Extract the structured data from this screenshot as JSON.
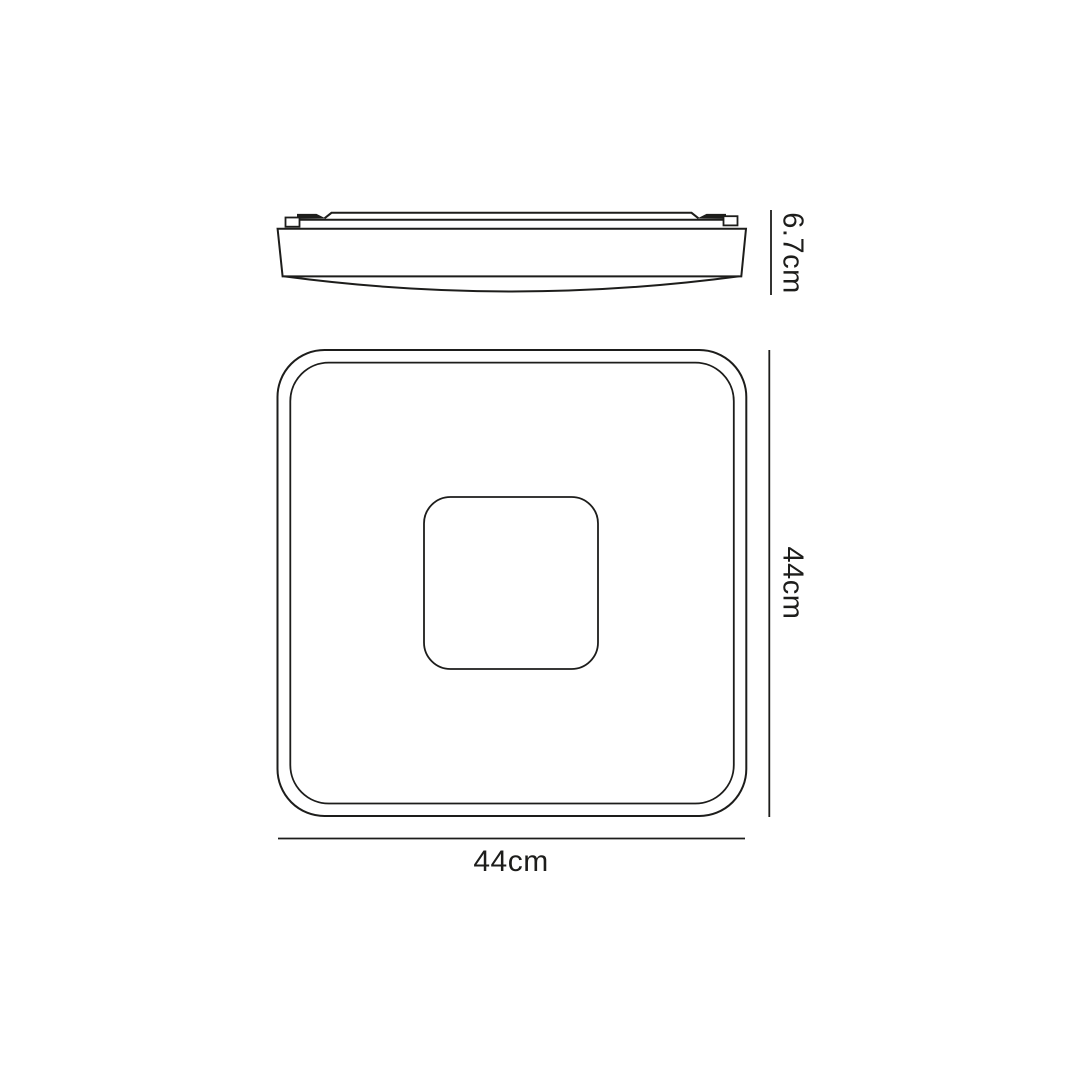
{
  "diagram": {
    "kind": "technical-dimension-drawing",
    "subject": "square flush ceiling light fixture, side profile view and front view",
    "colors": {
      "line": "#1d1d1b",
      "background": "#ffffff"
    },
    "side_view": {
      "height_label": "6.7cm"
    },
    "front_view": {
      "height_label": "44cm",
      "width_label": "44cm"
    }
  }
}
